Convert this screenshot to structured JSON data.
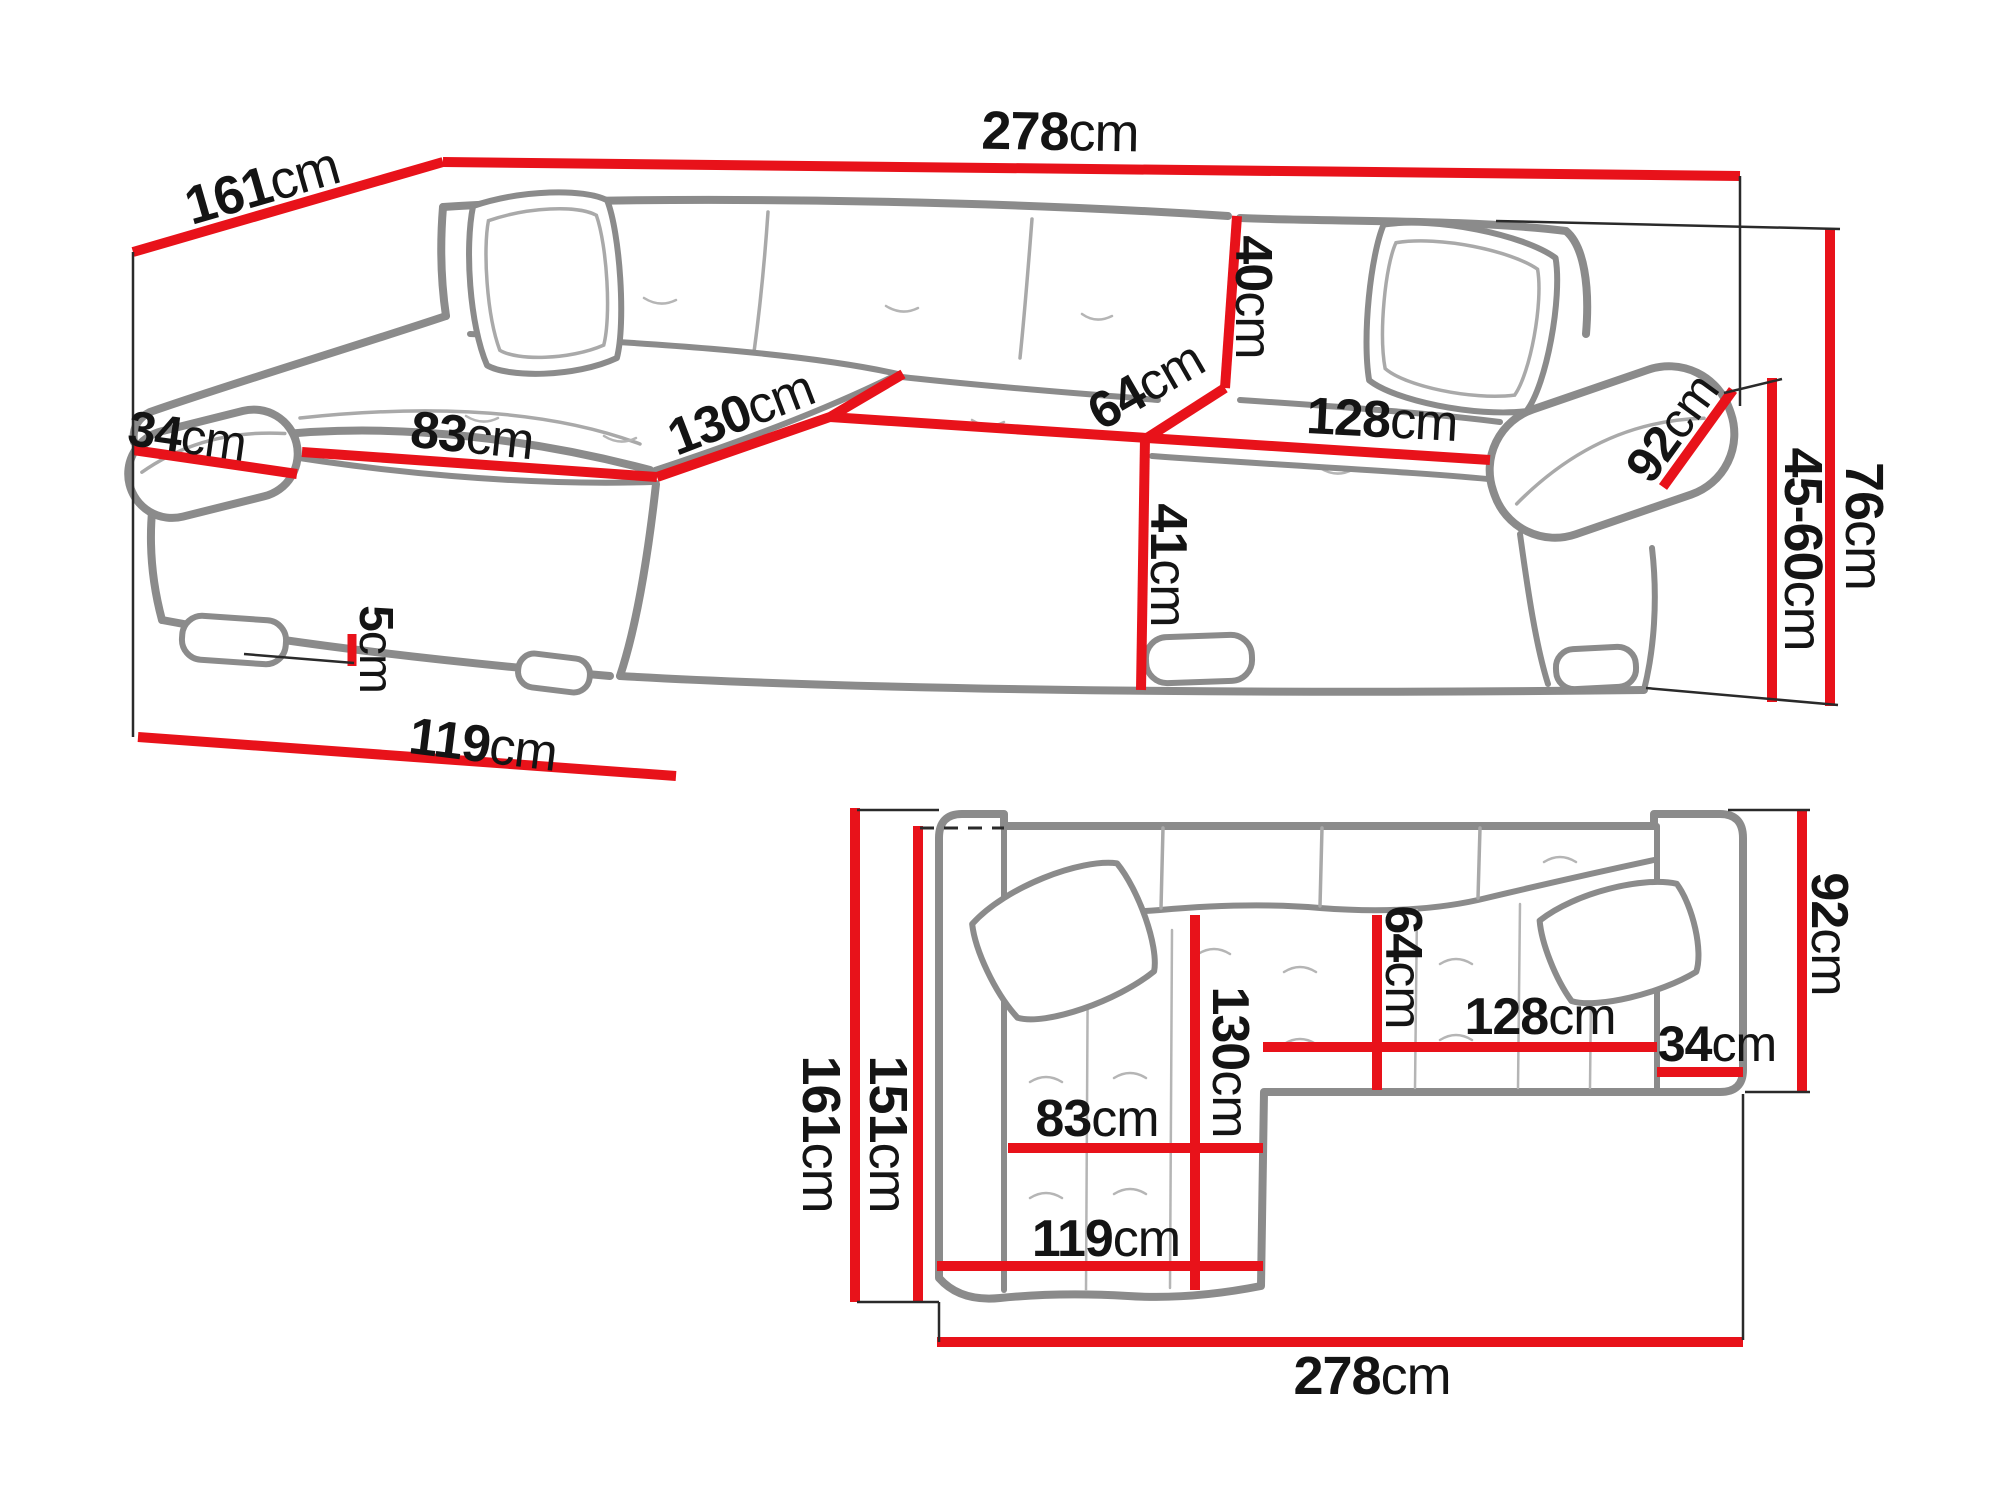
{
  "diagram": {
    "type": "furniture-dimension-diagram",
    "subject": "corner sofa bed with chaise longue, perspective view and top plan view",
    "unit": "cm",
    "colors": {
      "dimension_line": "#e8121a",
      "sofa_outline": "#8b8b8b",
      "sofa_seam": "#a9a9a9",
      "label_text": "#141414",
      "extension_line": "#2a2a2a",
      "background": "#ffffff"
    },
    "perspective_view": {
      "d161": {
        "value": "161",
        "unit": "cm"
      },
      "d278": {
        "value": "278",
        "unit": "cm"
      },
      "d34": {
        "value": "34",
        "unit": "cm"
      },
      "d83": {
        "value": "83",
        "unit": "cm"
      },
      "d130": {
        "value": "130",
        "unit": "cm"
      },
      "d64": {
        "value": "64",
        "unit": "cm"
      },
      "d40": {
        "value": "40",
        "unit": "cm"
      },
      "d41": {
        "value": "41",
        "unit": "cm"
      },
      "d128": {
        "value": "128",
        "unit": "cm"
      },
      "d92": {
        "value": "92",
        "unit": "cm"
      },
      "d5": {
        "value": "5",
        "unit": "cm"
      },
      "d119": {
        "value": "119",
        "unit": "cm"
      },
      "d76": {
        "value": "76",
        "unit": "cm"
      },
      "d45_60": {
        "value": "45-60",
        "unit": "cm"
      }
    },
    "plan_view": {
      "d161": {
        "value": "161",
        "unit": "cm"
      },
      "d151": {
        "value": "151",
        "unit": "cm"
      },
      "d130": {
        "value": "130",
        "unit": "cm"
      },
      "d64": {
        "value": "64",
        "unit": "cm"
      },
      "d83": {
        "value": "83",
        "unit": "cm"
      },
      "d119": {
        "value": "119",
        "unit": "cm"
      },
      "d128": {
        "value": "128",
        "unit": "cm"
      },
      "d34": {
        "value": "34",
        "unit": "cm"
      },
      "d92": {
        "value": "92",
        "unit": "cm"
      },
      "d278": {
        "value": "278",
        "unit": "cm"
      }
    }
  }
}
